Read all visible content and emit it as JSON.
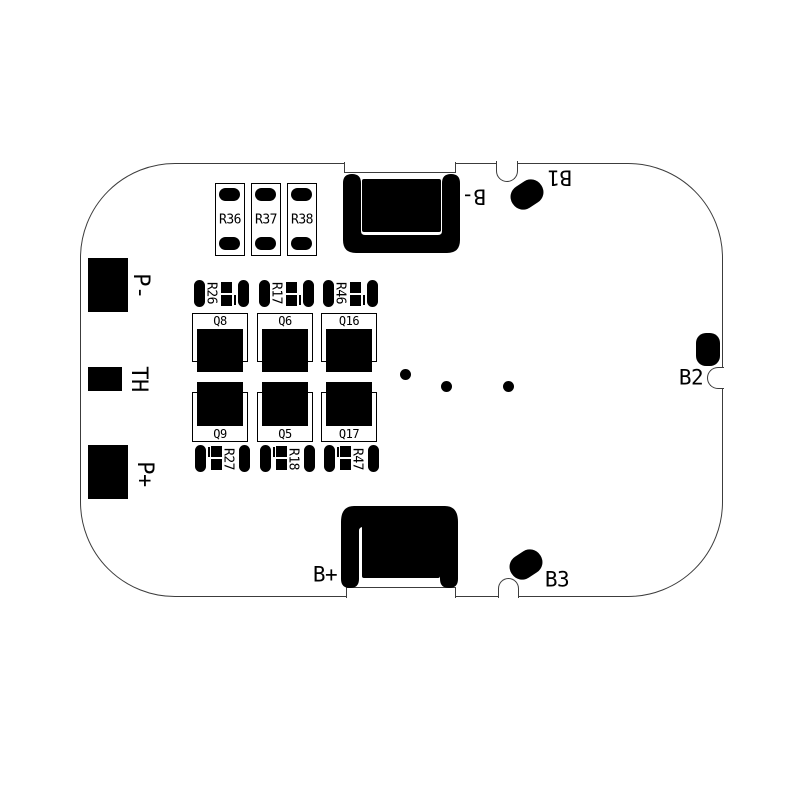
{
  "title": "BMS PCB layout diagram",
  "colors": {
    "silk": "#000000",
    "board_outline": "#3c3c3c",
    "background": "#ffffff"
  },
  "board": {
    "connector_pads": [
      {
        "label": "P-"
      },
      {
        "label": "TH"
      },
      {
        "label": "P+"
      }
    ],
    "balance_resistors": [
      {
        "label": "R36"
      },
      {
        "label": "R37"
      },
      {
        "label": "R38"
      }
    ],
    "fet_columns": [
      {
        "top_fet": "Q8",
        "bottom_fet": "Q9",
        "top_resistor": "R26",
        "bottom_resistor": "R27"
      },
      {
        "top_fet": "Q6",
        "bottom_fet": "Q5",
        "top_resistor": "R17",
        "bottom_resistor": "R18"
      },
      {
        "top_fet": "Q16",
        "bottom_fet": "Q17",
        "top_resistor": "R46",
        "bottom_resistor": "R47"
      }
    ],
    "battery_terminals": {
      "b_minus": {
        "label": "B-"
      },
      "b_plus": {
        "label": "B+"
      },
      "b1": {
        "label": "B1"
      },
      "b2": {
        "label": "B2"
      },
      "b3": {
        "label": "B3"
      }
    },
    "via_dots": 3
  }
}
